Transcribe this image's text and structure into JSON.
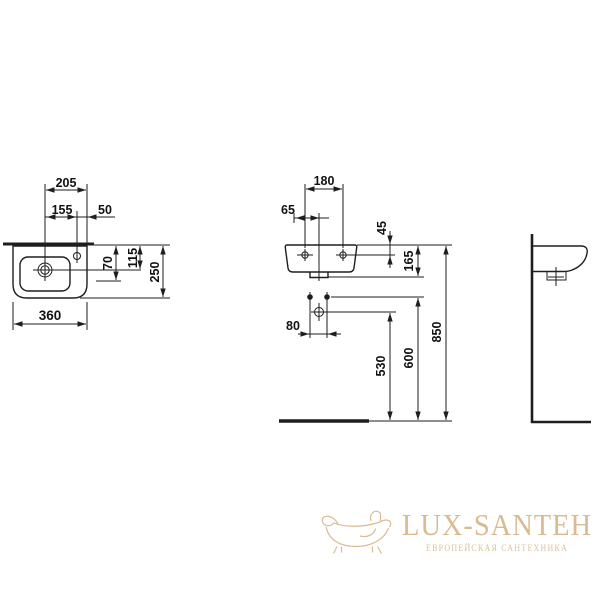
{
  "drawing": {
    "type": "washbasin technical dimension drawing",
    "ink_color": "#1e1e1e",
    "plan": {
      "dims": {
        "v205": "205",
        "v155": "155",
        "v50": "50",
        "v70": "70",
        "v115": "115",
        "v250": "250",
        "v360": "360"
      }
    },
    "front": {
      "dims": {
        "v180": "180",
        "v65": "65",
        "v45": "45",
        "v165": "165",
        "v80": "80",
        "v530": "530",
        "v600": "600",
        "v850": "850"
      }
    }
  },
  "logo": {
    "brand": "LUX-SANTEH",
    "tagline": "ЕВРОПЕЙСКАЯ САНТЕХНИКА",
    "gold": "#d9bb92",
    "gold_light": "#dcc19c"
  }
}
